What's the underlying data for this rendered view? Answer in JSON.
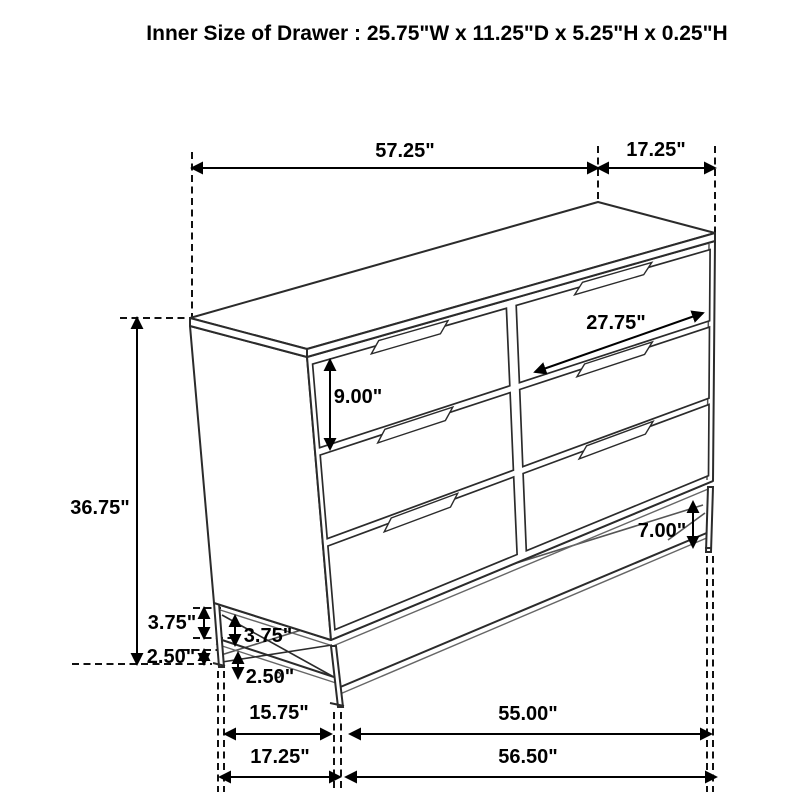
{
  "title": "Inner Size of Drawer : 25.75\"W x 11.25\"D x 5.25\"H x 0.25\"H",
  "diagram": {
    "type": "furniture-dimension-drawing",
    "subject": "6-drawer dresser on metal leg frame",
    "line_color": "#222222",
    "background_color": "#ffffff"
  },
  "dimensions": {
    "top_width": "57.25\"",
    "top_depth": "17.25\"",
    "overall_height": "36.75\"",
    "drawer_face_height": "9.00\"",
    "drawer_face_width": "27.75\"",
    "leg_height": "7.00\"",
    "side_rail_gap_rear": "3.75\"",
    "side_rail_gap_front": "3.75\"",
    "floor_clearance_rear": "2.50\"",
    "floor_clearance_front": "2.50\"",
    "base_depth_inner": "15.75\"",
    "base_width_inner": "55.00\"",
    "base_depth_outer": "17.25\"",
    "base_width_outer": "56.50\""
  }
}
